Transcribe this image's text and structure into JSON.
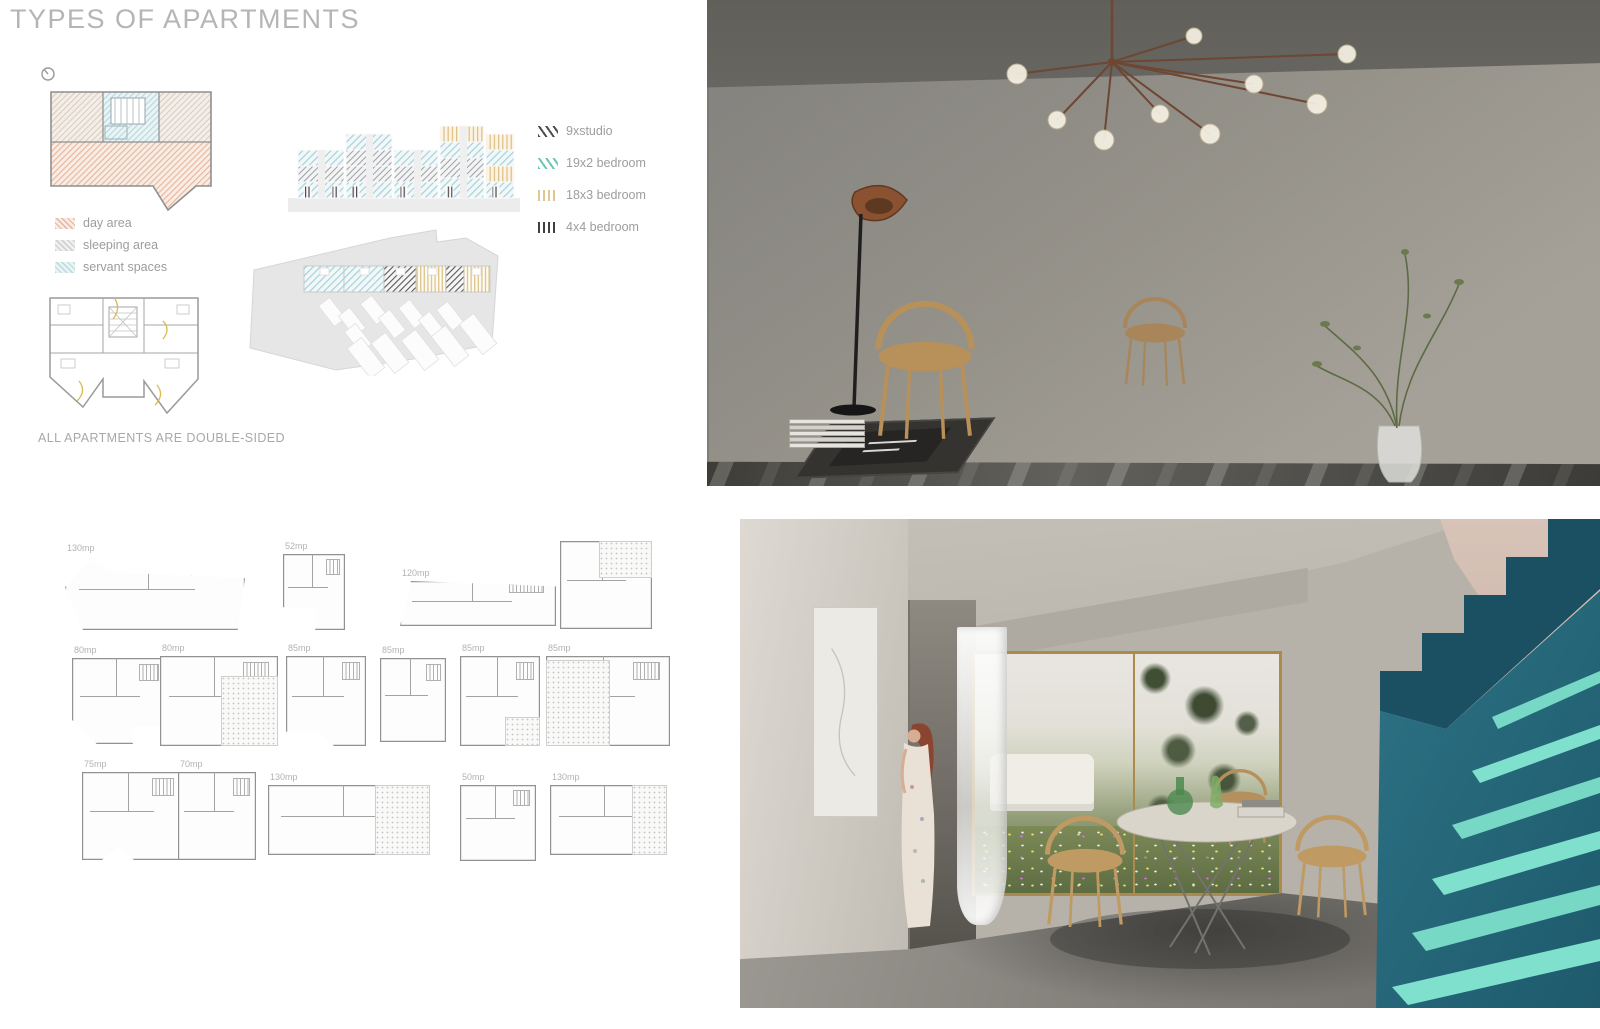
{
  "poster": {
    "title": "TYPES OF APARTMENTS",
    "note": "ALL APARTMENTS ARE DOUBLE-SIDED"
  },
  "area_legend": {
    "items": [
      {
        "label": "day area",
        "color": "#eac3ae"
      },
      {
        "label": "sleeping area",
        "color": "#d9d9d9"
      },
      {
        "label": "servant spaces",
        "color": "#cfe4ea"
      }
    ]
  },
  "unit_legend": {
    "items": [
      {
        "label": "9xstudio",
        "color": "#4f4f4f",
        "hatch": "diagonal"
      },
      {
        "label": "19x2 bedroom",
        "color": "#6cc5b5",
        "hatch": "diagonal"
      },
      {
        "label": "18x3 bedroom",
        "color": "#dfc792",
        "hatch": "vertical"
      },
      {
        "label": "4x4 bedroom",
        "color": "#3f3f3f",
        "hatch": "vertical"
      }
    ]
  },
  "unit_plans": {
    "items": [
      {
        "label": "130mp"
      },
      {
        "label": "52mp"
      },
      {
        "label": "120mp"
      },
      {
        "label": ""
      },
      {
        "label": "80mp"
      },
      {
        "label": "80mp"
      },
      {
        "label": "85mp"
      },
      {
        "label": "85mp"
      },
      {
        "label": "85mp"
      },
      {
        "label": "85mp"
      },
      {
        "label": "75mp"
      },
      {
        "label": "70mp"
      },
      {
        "label": "130mp"
      },
      {
        "label": "50mp"
      },
      {
        "label": "130mp"
      }
    ]
  },
  "colors": {
    "stair_teal_dark": "#1b5062",
    "stair_teal_mid": "#2e7386",
    "stair_mint": "#7fe0cd",
    "gold_frame": "#ab8a4c",
    "title_gray": "#b5b5b5"
  }
}
